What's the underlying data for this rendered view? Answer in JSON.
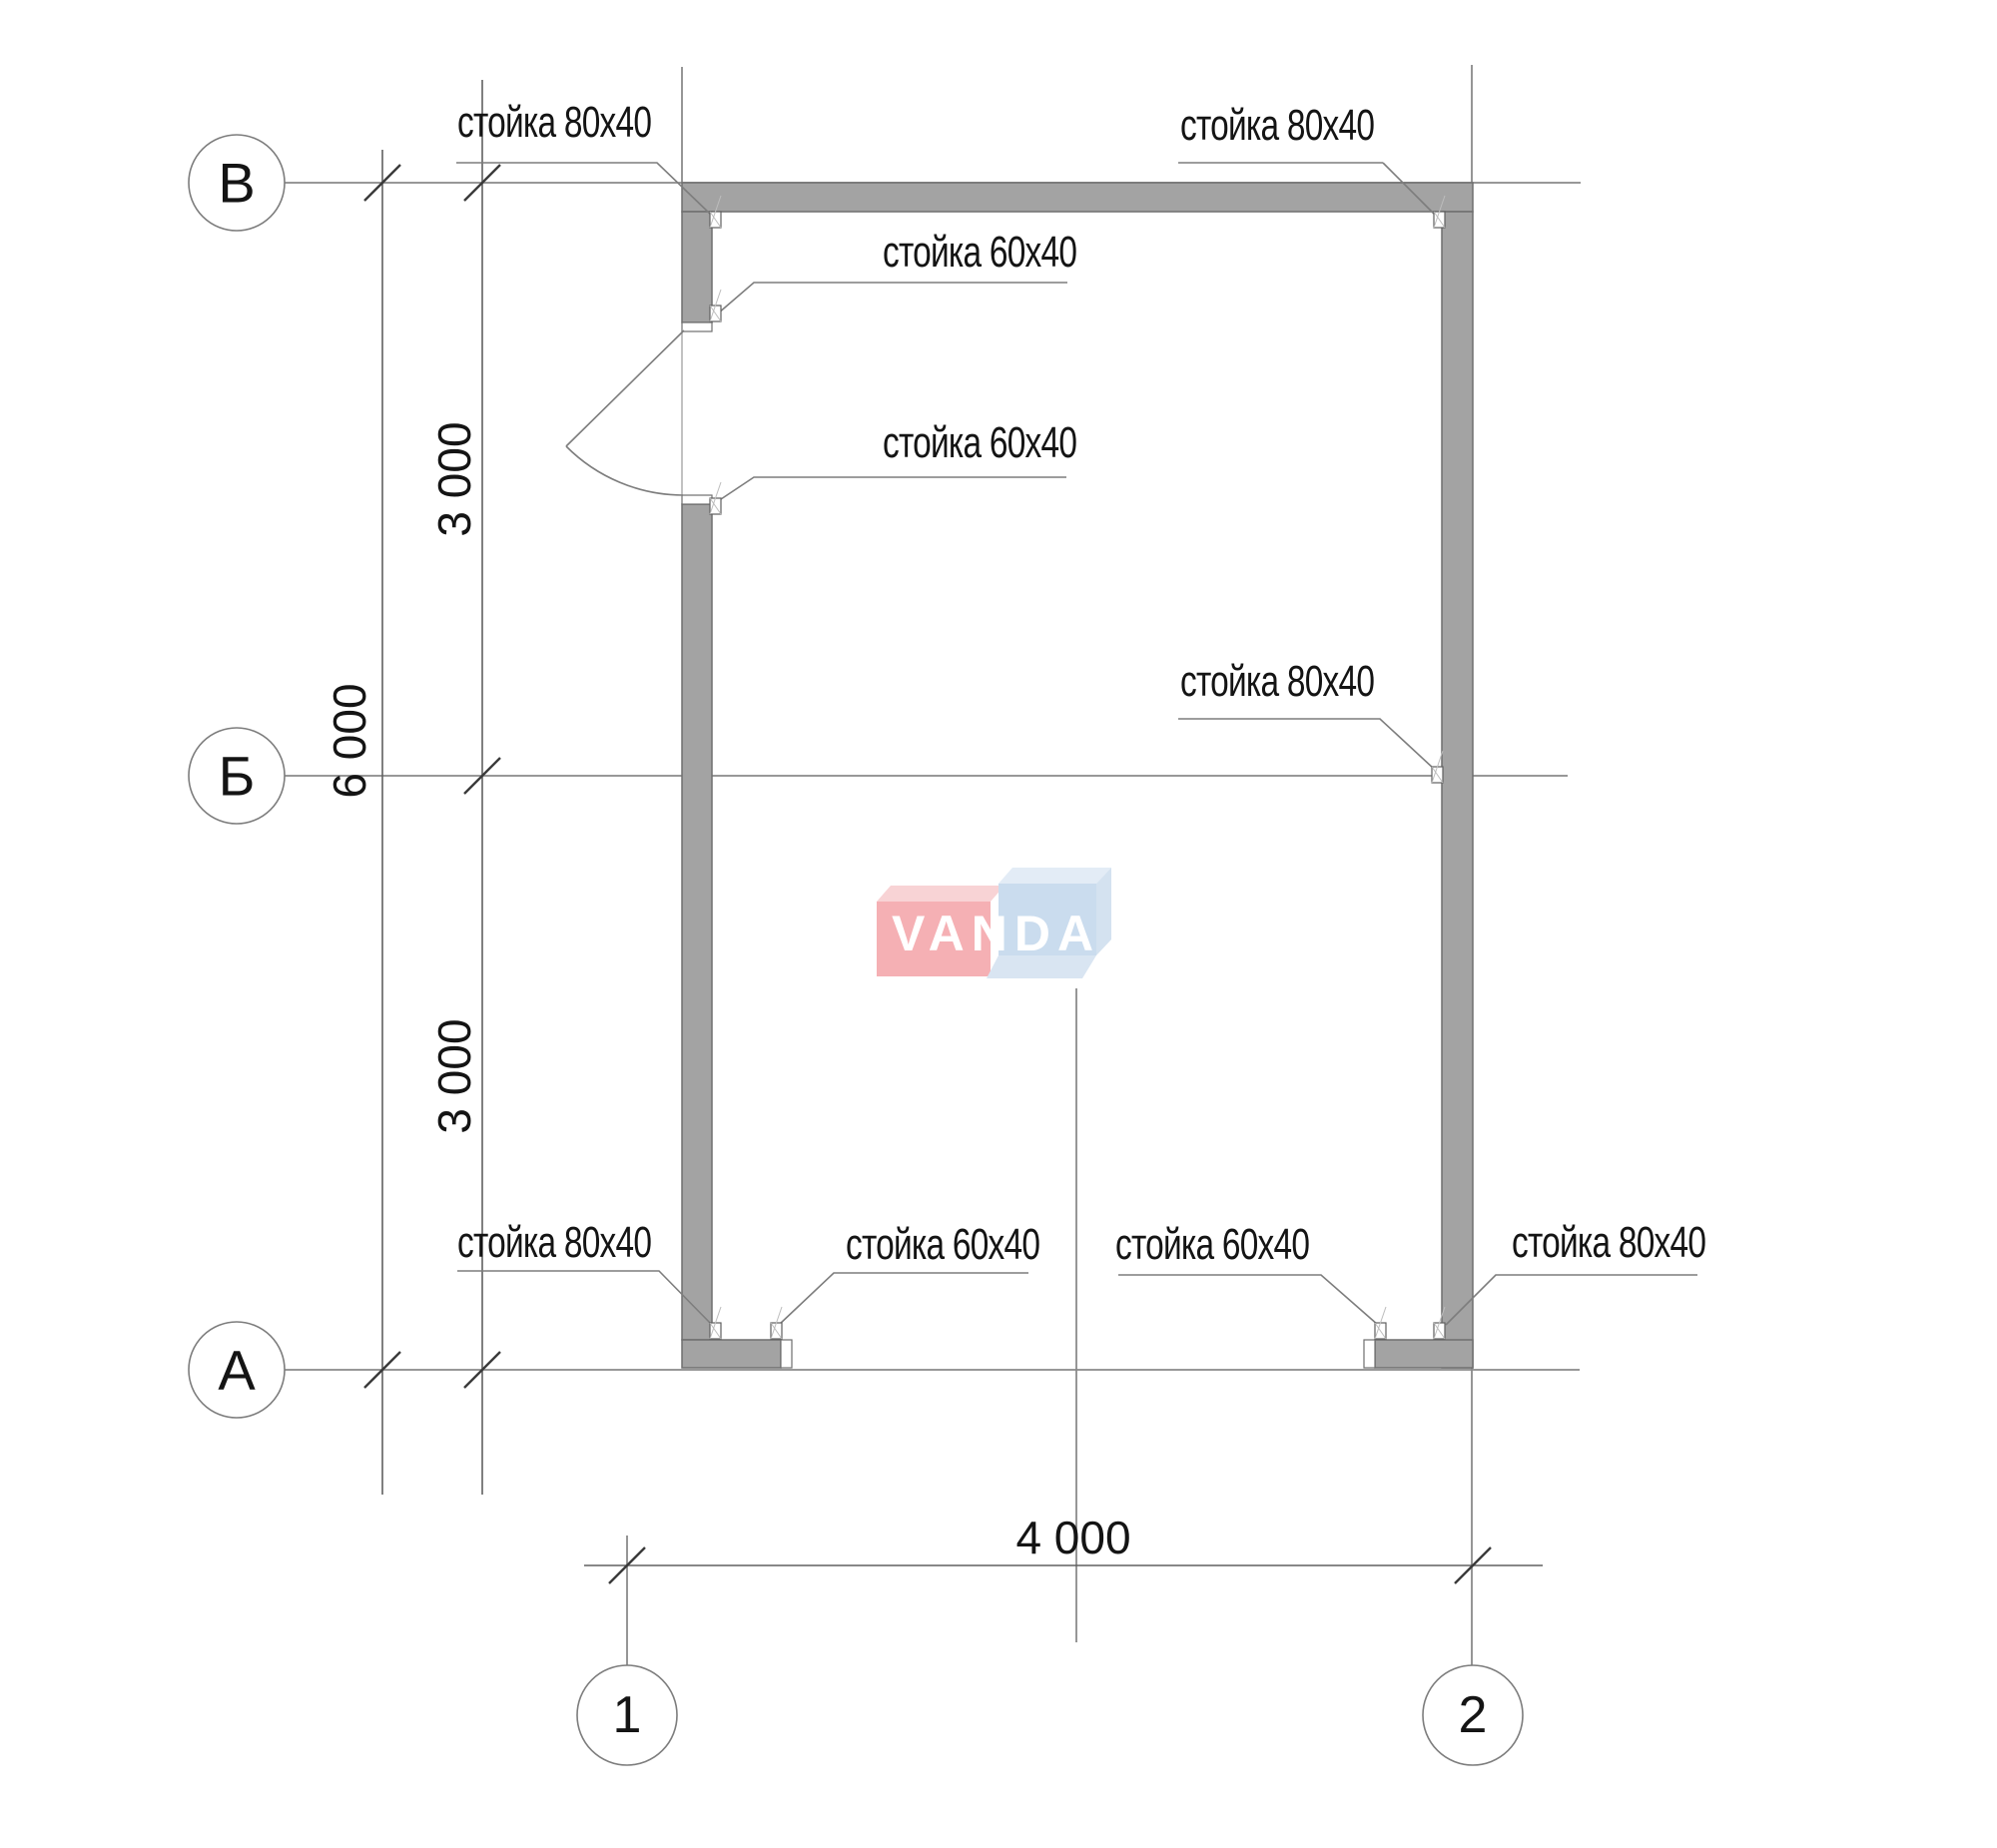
{
  "drawing": {
    "axis_circles_horizontal": [
      {
        "label": "В"
      },
      {
        "label": "Б"
      },
      {
        "label": "А"
      }
    ],
    "axis_circles_vertical": [
      {
        "label": "1"
      },
      {
        "label": "2"
      }
    ],
    "dimensions": {
      "left_total": "6 000",
      "left_upper": "3 000",
      "left_lower": "3 000",
      "bottom": "4 000"
    },
    "labels": [
      {
        "id": "post-top-left",
        "text": "стойка 80x40"
      },
      {
        "id": "post-top-right",
        "text": "стойка 80x40"
      },
      {
        "id": "post-door-top",
        "text": "стойка 60x40"
      },
      {
        "id": "post-door-bottom",
        "text": "стойка 60x40"
      },
      {
        "id": "post-mid-right",
        "text": "стойка 80x40"
      },
      {
        "id": "post-bottom-left",
        "text": "стойка 80x40"
      },
      {
        "id": "post-opening-left",
        "text": "стойка 60x40"
      },
      {
        "id": "post-opening-right",
        "text": "стойка 60x40"
      },
      {
        "id": "post-bottom-right",
        "text": "стойка 80x40"
      }
    ],
    "watermark": {
      "text": "VANDA"
    },
    "colors": {
      "wall_fill": "#a3a3a3",
      "wall_stroke": "#6f6f6f",
      "thin_line": "#7d7d7d",
      "tick": "#3a3a3a",
      "text": "#141414",
      "logo_red": "#f5b0b4",
      "logo_red_light": "#f8d3d5",
      "logo_blue": "#cadcee",
      "logo_blue_light": "#dfeaf4",
      "logo_text": "#ffffff"
    }
  }
}
